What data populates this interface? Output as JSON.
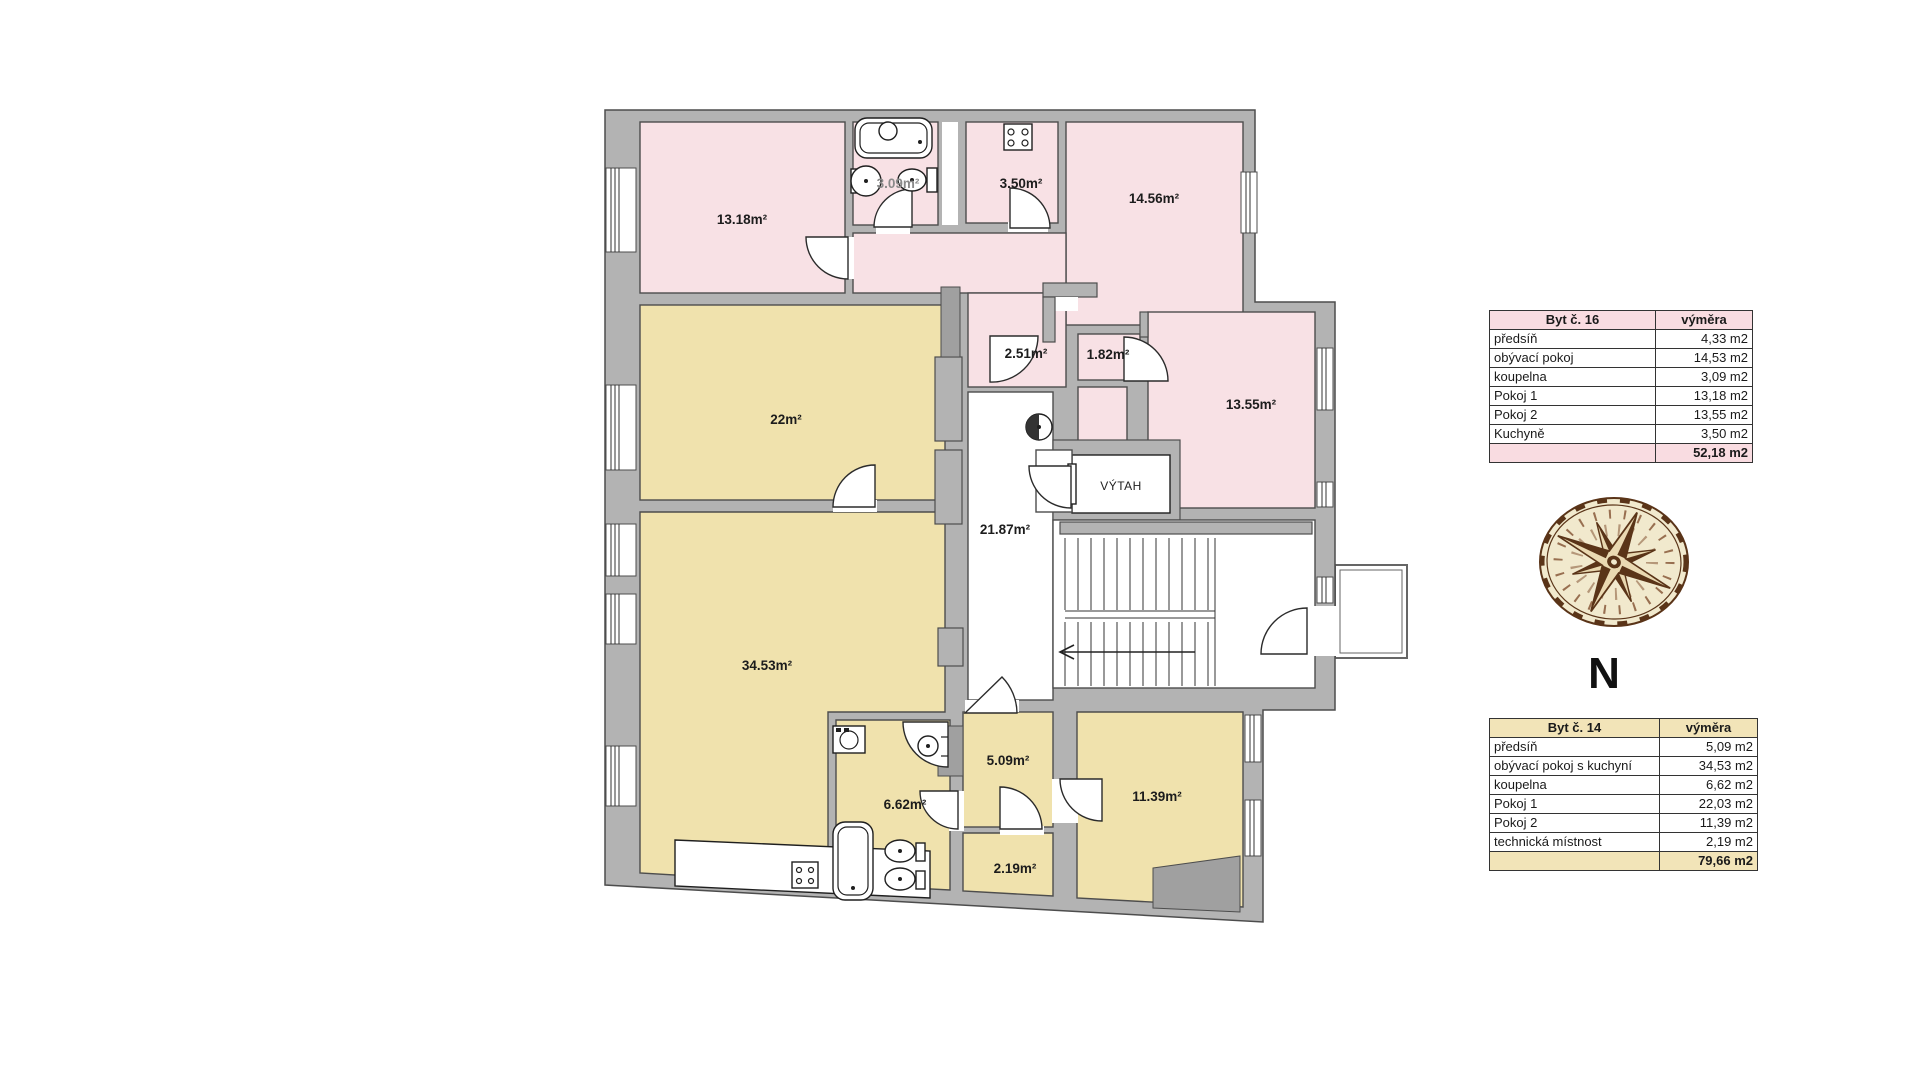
{
  "plan": {
    "labels": {
      "room_13_18": "13.18m²",
      "bath_309": "3.09m²",
      "kitchen_350": "3.50m²",
      "living_1456": "14.56m²",
      "hall_251": "2.51m²",
      "hall_182": "1.82m²",
      "room_1355": "13.55m²",
      "room_22": "22m²",
      "corridor_2187": "21.87m²",
      "room_3453": "34.53m²",
      "bath_662": "6.62m²",
      "hall_509": "5.09m²",
      "room_1139": "11.39m²",
      "tech_219": "2.19m²",
      "elevator": "VÝTAH"
    },
    "compass_north": "N"
  },
  "tables": {
    "byt16": {
      "title": "Byt č. 16",
      "area_header": "výměra",
      "rows": [
        {
          "label": "předsíň",
          "value": "4,33 m2"
        },
        {
          "label": "obývací pokoj",
          "value": "14,53 m2"
        },
        {
          "label": "koupelna",
          "value": "3,09 m2"
        },
        {
          "label": "Pokoj 1",
          "value": "13,18 m2"
        },
        {
          "label": "Pokoj 2",
          "value": "13,55 m2"
        },
        {
          "label": "Kuchyně",
          "value": "3,50 m2"
        }
      ],
      "total": "52,18 m2"
    },
    "byt14": {
      "title": "Byt č. 14",
      "area_header": "výměra",
      "rows": [
        {
          "label": "předsíň",
          "value": "5,09 m2"
        },
        {
          "label": "obývací pokoj s kuchyní",
          "value": "34,53 m2"
        },
        {
          "label": "koupelna",
          "value": "6,62 m2"
        },
        {
          "label": "Pokoj 1",
          "value": "22,03 m2"
        },
        {
          "label": "Pokoj 2",
          "value": "11,39 m2"
        },
        {
          "label": "technická místnost",
          "value": "2,19 m2"
        }
      ],
      "total": "79,66 m2"
    }
  },
  "colors": {
    "apartment16": "#f8e1e5",
    "apartment14": "#f0e2ad",
    "wall": "#b3b3b3",
    "table16_accent": "#f9dce1",
    "table14_accent": "#f2e4b8",
    "compass_brown": "#5a3418"
  }
}
